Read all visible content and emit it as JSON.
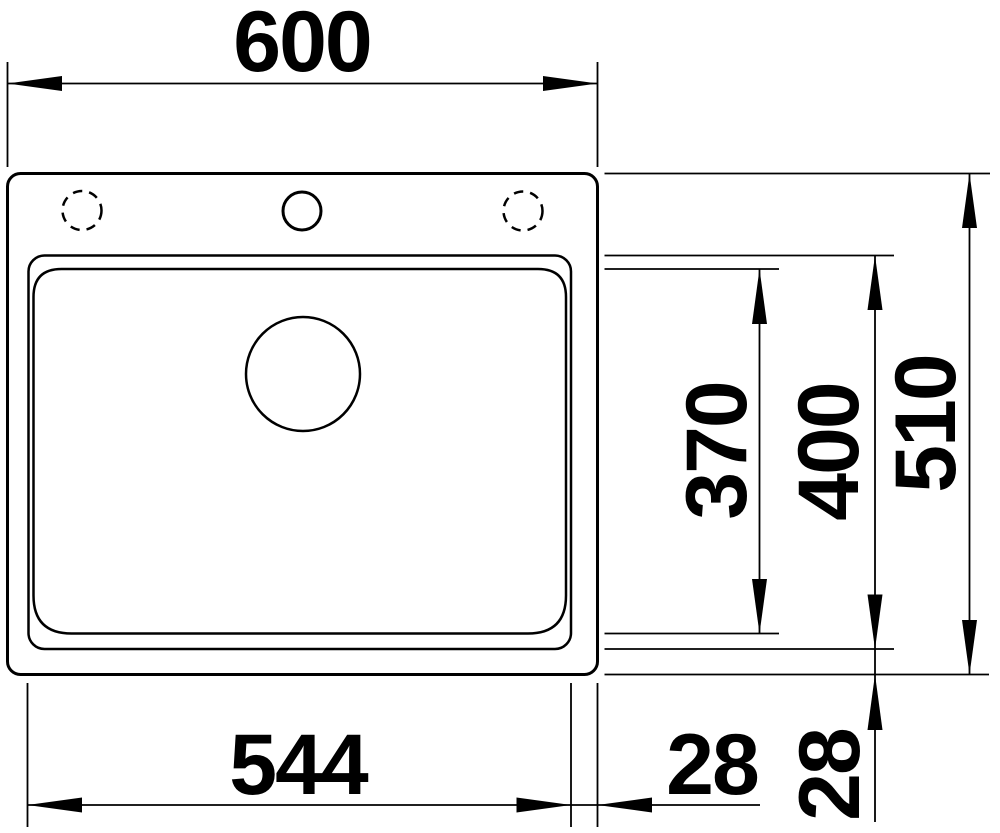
{
  "colors": {
    "line": "#000000",
    "background": "#ffffff"
  },
  "dimensions": {
    "overall_width": "600",
    "overall_depth": "510",
    "bowl_depth_outer": "400",
    "bowl_depth_inner": "370",
    "bowl_width": "544",
    "offset_bowl_to_edge_right": "28",
    "offset_bowl_to_edge_bottom": "28"
  }
}
